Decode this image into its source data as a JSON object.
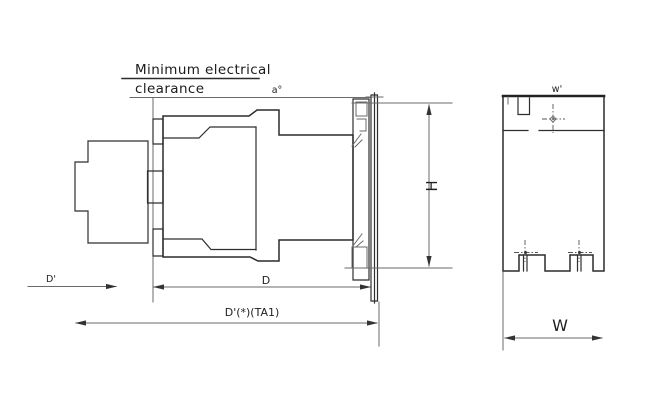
{
  "page": {
    "background": "#ffffff",
    "line_color": "#2f2f2f"
  },
  "note": {
    "line1": "Minimum electrical",
    "line2": "clearance"
  },
  "dimensions": {
    "a": "a°",
    "h": "H",
    "d_prime": "D'",
    "d": "D",
    "d_total": "D'(*)(TA1)",
    "w_small": "w'",
    "w": "W"
  }
}
